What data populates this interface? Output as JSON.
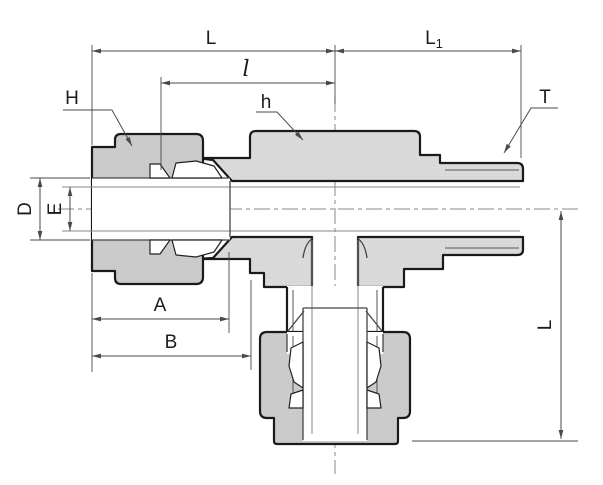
{
  "drawing": {
    "type": "technical-cross-section",
    "subject": "male-run-tee-compression-fitting",
    "labels": {
      "dim_L_run": "L",
      "dim_L1": {
        "base": "L",
        "sub": "1"
      },
      "dim_l_small": "l",
      "dim_H_nut": "H",
      "dim_h_body_hex": "h",
      "dim_T_thread": "T",
      "dim_D_tube_od": "D",
      "dim_E_bore": "E",
      "dim_A": "A",
      "dim_B": "B",
      "dim_L_vertical": "L"
    },
    "colors": {
      "background": "#ffffff",
      "outline": "#1a1a1a",
      "nut_fill": "#cdcdcd",
      "nut_mesh": "#bdbdbd",
      "body_fill": "#dcdcdc",
      "body_mesh": "#cccccc",
      "ferrule_fill": "#ffffff",
      "internal_line": "#444444",
      "soft_line": "#888888",
      "thread_line": "#555555",
      "dim_line": "#4a4a4a",
      "centerline": "#8a8a8a",
      "label_text": "#1c1c1c"
    }
  }
}
